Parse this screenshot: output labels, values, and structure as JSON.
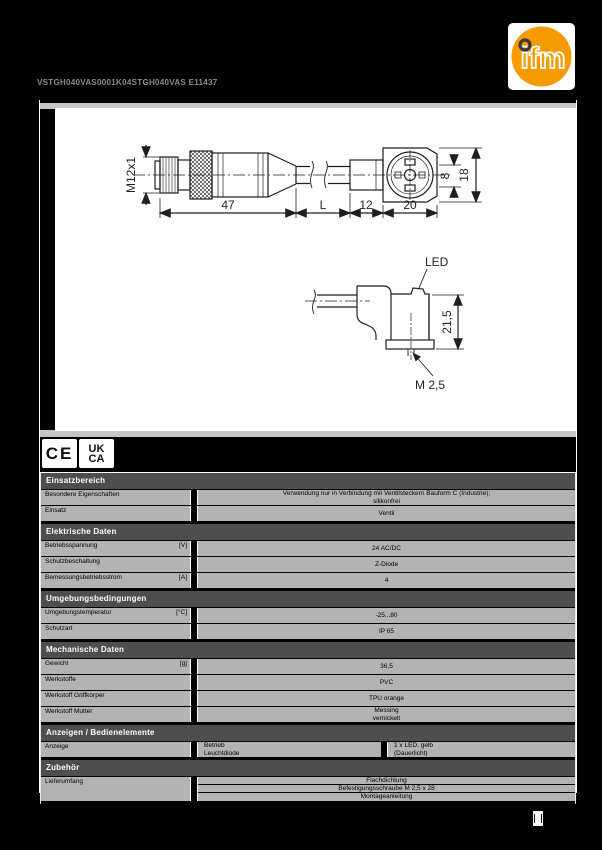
{
  "header": {
    "title": "VSTGH040VAS0001K04STGH040VAS E11437",
    "logo_text": "ifm",
    "logo_color": "#F59B00"
  },
  "marks": {
    "ce": "CE",
    "ukca_line1": "UK",
    "ukca_line2": "CA"
  },
  "drawing": {
    "labels": {
      "thread": "M12x1",
      "len_connector": "47",
      "len_cable": "L",
      "len_sleeve": "12",
      "len_housing": "20",
      "height_inner": "8",
      "height_outer": "18",
      "led": "LED",
      "height_plug": "21,5",
      "screw": "M 2,5"
    }
  },
  "colors": {
    "section_band": "#4e4e4e",
    "row_band": "#b3b3b3",
    "page_bg": "#000000"
  },
  "table": {
    "sections": [
      {
        "title": "Einsatzbereich",
        "rows": [
          {
            "label": "Besondere Eigenschaften",
            "unit": "",
            "values": [
              "Verwendung nur in Verbindung mit Ventilsteckern Bauform C (Industrie);",
              "silikonfrei"
            ]
          },
          {
            "label": "Einsatz",
            "unit": "",
            "values": [
              "Ventil"
            ]
          }
        ]
      },
      {
        "title": "Elektrische Daten",
        "rows": [
          {
            "label": "Betriebsspannung",
            "unit": "[V]",
            "values": [
              "24 AC/DC"
            ]
          },
          {
            "label": "Schutzbeschaltung",
            "unit": "",
            "values": [
              "Z-Diode"
            ]
          },
          {
            "label": "Bemessungsbetriebsstrom",
            "unit": "[A]",
            "values": [
              "4"
            ]
          }
        ]
      },
      {
        "title": "Umgebungsbedingungen",
        "rows": [
          {
            "label": "Umgebungstemperatur",
            "unit": "[°C]",
            "values": [
              "-25...80"
            ]
          },
          {
            "label": "Schutzart",
            "unit": "",
            "values": [
              "IP 65"
            ]
          }
        ]
      },
      {
        "title": "Mechanische Daten",
        "rows": [
          {
            "label": "Gewicht",
            "unit": "[g]",
            "values": [
              "36,5"
            ]
          },
          {
            "label": "Werkstoffe",
            "unit": "",
            "values": [
              "PVC"
            ]
          },
          {
            "label": "Werkstoff Griffkörper",
            "unit": "",
            "values": [
              "TPU orange"
            ]
          },
          {
            "label": "Werkstoff Mutter",
            "unit": "",
            "values": [
              "Messing",
              "vernickelt"
            ]
          }
        ]
      },
      {
        "title": "Anzeigen / Bedienelemente",
        "rows3": [
          {
            "label": "Anzeige",
            "col2": [
              "Betrieb",
              "Leuchtdiode"
            ],
            "col3": [
              "1 x LED, gelb",
              "(Dauerlicht)"
            ]
          }
        ]
      },
      {
        "title": "Zubehör",
        "rows": [
          {
            "label": "Lieferumfang",
            "unit": "",
            "values": [
              "Flachdichtung",
              "Befestigungsschraube M 2,5 x 28",
              "Montageanleitung"
            ]
          }
        ]
      }
    ]
  }
}
